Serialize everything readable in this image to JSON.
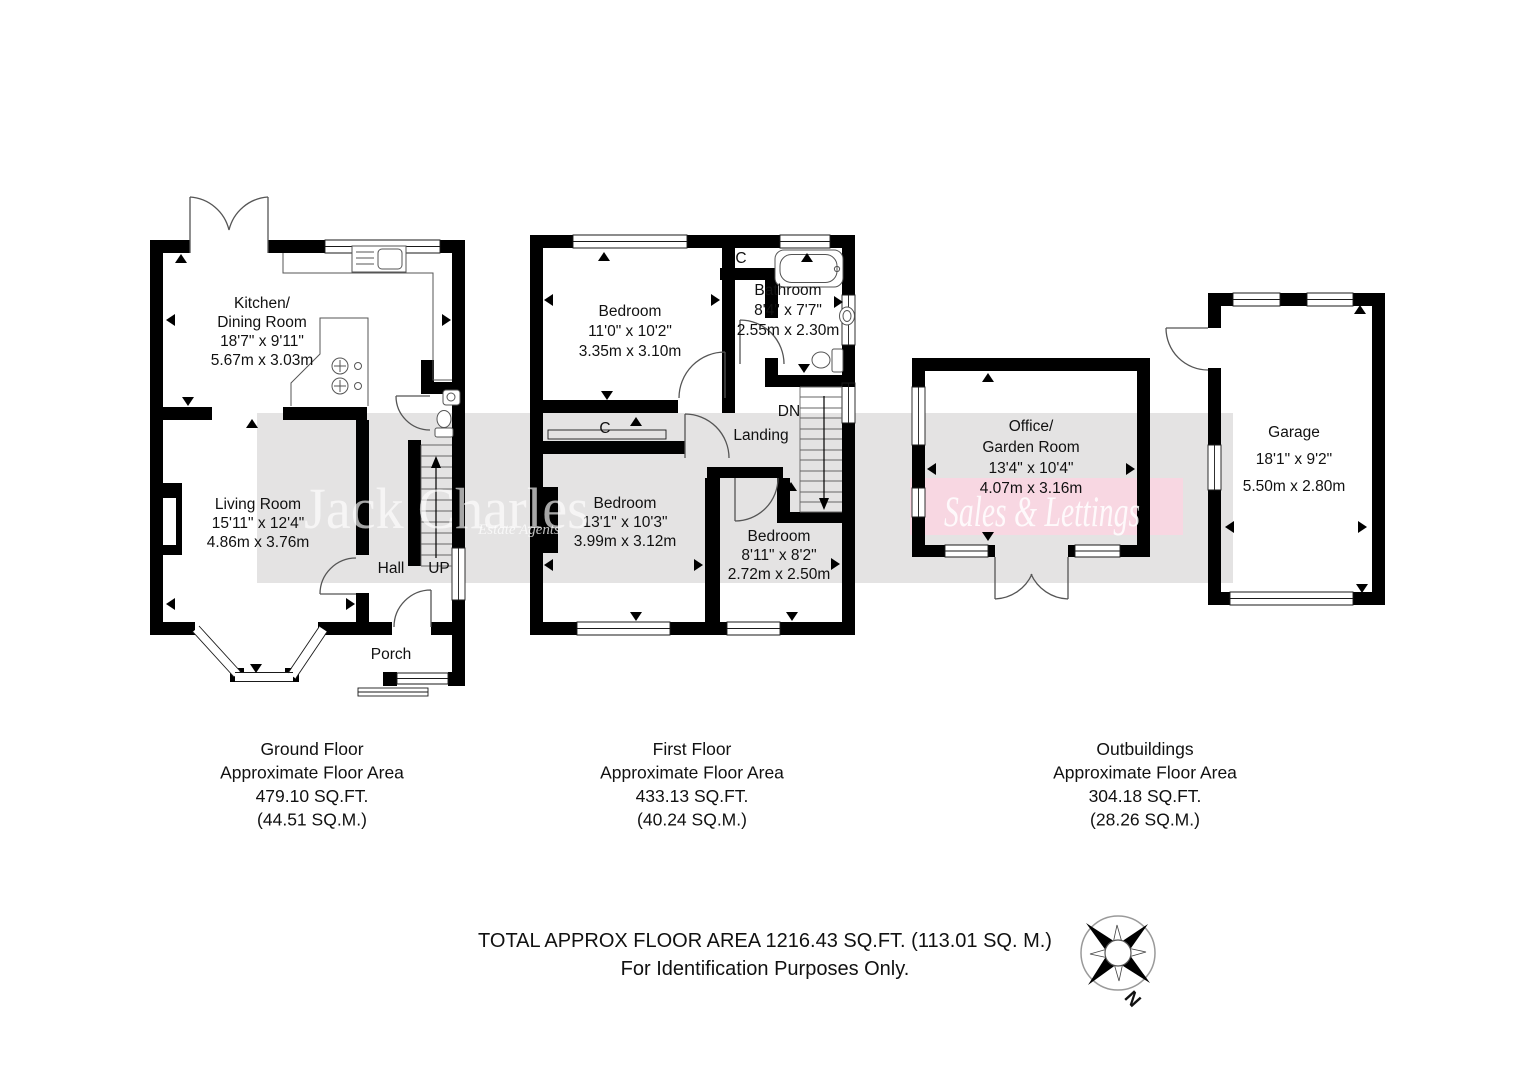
{
  "watermark": {
    "name": "Jack Charles",
    "tagline": "Estate Agents",
    "banner": "Sales & Lettings",
    "gray_band_color": "#e4e3e3",
    "pink_band_color": "#f8d7e2"
  },
  "ground_floor": {
    "plan": {
      "kitchen_line1": "Kitchen/",
      "kitchen_line2": "Dining Room",
      "kitchen_imperial": "18'7\" x 9'11\"",
      "kitchen_metric": "5.67m x 3.03m",
      "living_line1": "Living Room",
      "living_imperial": "15'11\" x 12'4\"",
      "living_metric": "4.86m x 3.76m",
      "hall": "Hall",
      "up": "UP",
      "porch": "Porch"
    },
    "caption": {
      "title": "Ground Floor",
      "subtitle": "Approximate Floor Area",
      "sqft": "479.10 SQ.FT.",
      "sqm": "(44.51 SQ.M.)"
    }
  },
  "first_floor": {
    "plan": {
      "bedroom1_name": "Bedroom",
      "bedroom1_imperial": "11'0\" x 10'2\"",
      "bedroom1_metric": "3.35m x 3.10m",
      "cupboard_top": "C",
      "bathroom_name": "Bathroom",
      "bathroom_imperial": "8'4\" x 7'7\"",
      "bathroom_metric": "2.55m x 2.30m",
      "dn": "DN",
      "landing": "Landing",
      "cupboard_mid": "C",
      "bedroom2_name": "Bedroom",
      "bedroom2_imperial": "13'1\" x 10'3\"",
      "bedroom2_metric": "3.99m x 3.12m",
      "bedroom3_name": "Bedroom",
      "bedroom3_imperial": "8'11\" x 8'2\"",
      "bedroom3_metric": "2.72m x 2.50m"
    },
    "caption": {
      "title": "First Floor",
      "subtitle": "Approximate Floor Area",
      "sqft": "433.13 SQ.FT.",
      "sqm": "(40.24 SQ.M.)"
    }
  },
  "outbuildings": {
    "plan": {
      "office_line1": "Office/",
      "office_line2": "Garden Room",
      "office_imperial": "13'4\" x 10'4\"",
      "office_metric": "4.07m x 3.16m",
      "garage_name": "Garage",
      "garage_imperial": "18'1\" x 9'2\"",
      "garage_metric": "5.50m x 2.80m"
    },
    "caption": {
      "title": "Outbuildings",
      "subtitle": "Approximate Floor Area",
      "sqft": "304.18 SQ.FT.",
      "sqm": "(28.26 SQ.M.)"
    }
  },
  "footer": {
    "total": "TOTAL APPROX FLOOR AREA 1216.43 SQ.FT. (113.01 SQ. M.)",
    "disclaimer": "For Identification Purposes Only.",
    "compass_north": "N"
  }
}
